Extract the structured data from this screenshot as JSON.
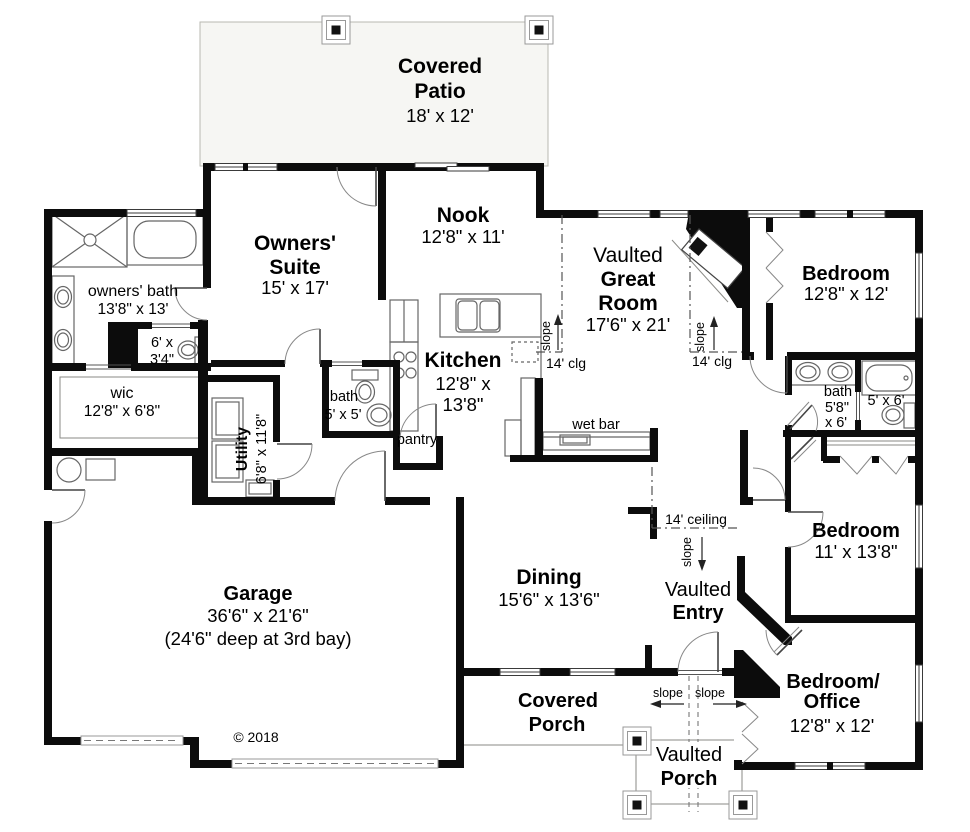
{
  "plan": {
    "copyright": "© 2018",
    "rooms": {
      "covered_patio": {
        "line1": "Covered",
        "line2": "Patio",
        "dims": "18' x 12'"
      },
      "owners_suite": {
        "line1": "Owners'",
        "line2": "Suite",
        "dims": "15' x 17'"
      },
      "nook": {
        "name": "Nook",
        "dims": "12'8\" x 11'"
      },
      "great_room": {
        "line1": "Vaulted",
        "line2": "Great",
        "line3": "Room",
        "dims": "17'6\" x 21'"
      },
      "bedroom_upper": {
        "name": "Bedroom",
        "dims": "12'8\" x 12'"
      },
      "owners_bath": {
        "name": "owners' bath",
        "dims": "13'8\" x 13'"
      },
      "toilet_room": {
        "dims_line1": "6' x",
        "dims_line2": "3'4\""
      },
      "wic": {
        "name": "wic",
        "dims": "12'8\" x 6'8\""
      },
      "utility": {
        "name": "Utility",
        "dims": "6'8\" x 11'8\""
      },
      "bath": {
        "name": "bath",
        "dims": "5' x 5'"
      },
      "pantry": {
        "name": "pantry"
      },
      "kitchen": {
        "name": "Kitchen",
        "dims_line1": "12'8\" x",
        "dims_line2": "13'8\""
      },
      "wet_bar": {
        "name": "wet bar"
      },
      "dining": {
        "name": "Dining",
        "dims": "15'6\" x 13'6\""
      },
      "garage": {
        "name": "Garage",
        "dims": "36'6\" x 21'6\"",
        "note": "(24'6\" deep at 3rd bay)"
      },
      "covered_porch": {
        "line1": "Covered",
        "line2": "Porch"
      },
      "vaulted_porch": {
        "line1": "Vaulted",
        "line2": "Porch"
      },
      "vaulted_entry": {
        "line1": "Vaulted",
        "line2": "Entry"
      },
      "bedroom_middle": {
        "name": "Bedroom",
        "dims": "11' x 13'8\""
      },
      "bedroom_office": {
        "line1": "Bedroom/",
        "line2": "Office",
        "dims": "12'8\" x 12'"
      },
      "hall_bath": {
        "name": "bath",
        "dims_line1": "5'8\"",
        "dims_line2": "x 6'"
      },
      "hall_bath_wc": {
        "dims": "5' x 6'"
      }
    },
    "annotations": {
      "slope": "slope",
      "clg": "14' clg",
      "ceiling": "14' ceiling"
    },
    "colors": {
      "wall": "#0c0c0c",
      "patio_fill": "#f6f6f3",
      "fixture_line": "#666666"
    }
  }
}
